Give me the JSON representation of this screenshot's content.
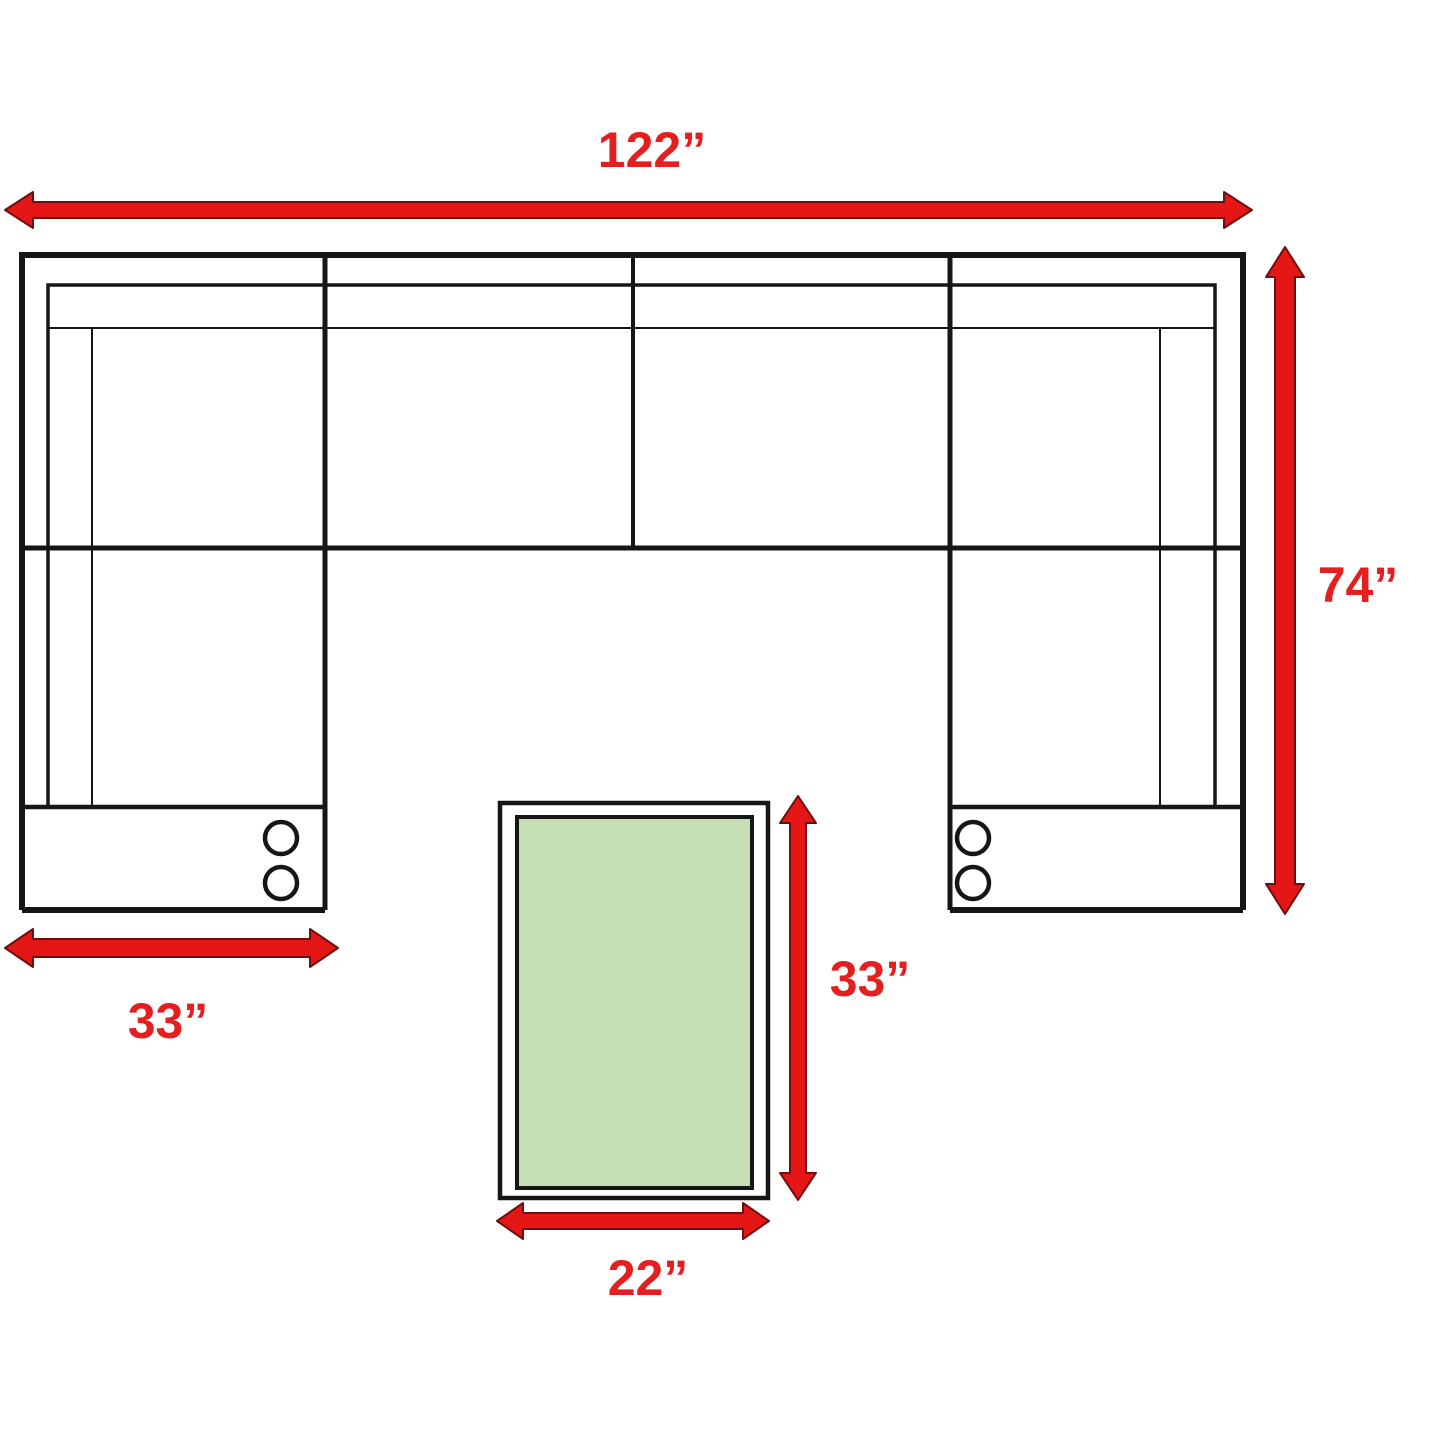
{
  "diagram": {
    "type": "furniture-dimension-floorplan",
    "labels": {
      "sofa_width": "122”",
      "sofa_depth": "74”",
      "chaise_width": "33”",
      "table_length": "33”",
      "table_width": "22”"
    },
    "colors": {
      "arrow_red": "#e41616",
      "label_red": "#e3201f",
      "line_black": "#161616",
      "table_green": "#c5deb4",
      "background": "#ffffff"
    },
    "icons": {
      "cup_holder": "outlined-circle",
      "dimension_arrow": "double-headed-arrow"
    }
  }
}
